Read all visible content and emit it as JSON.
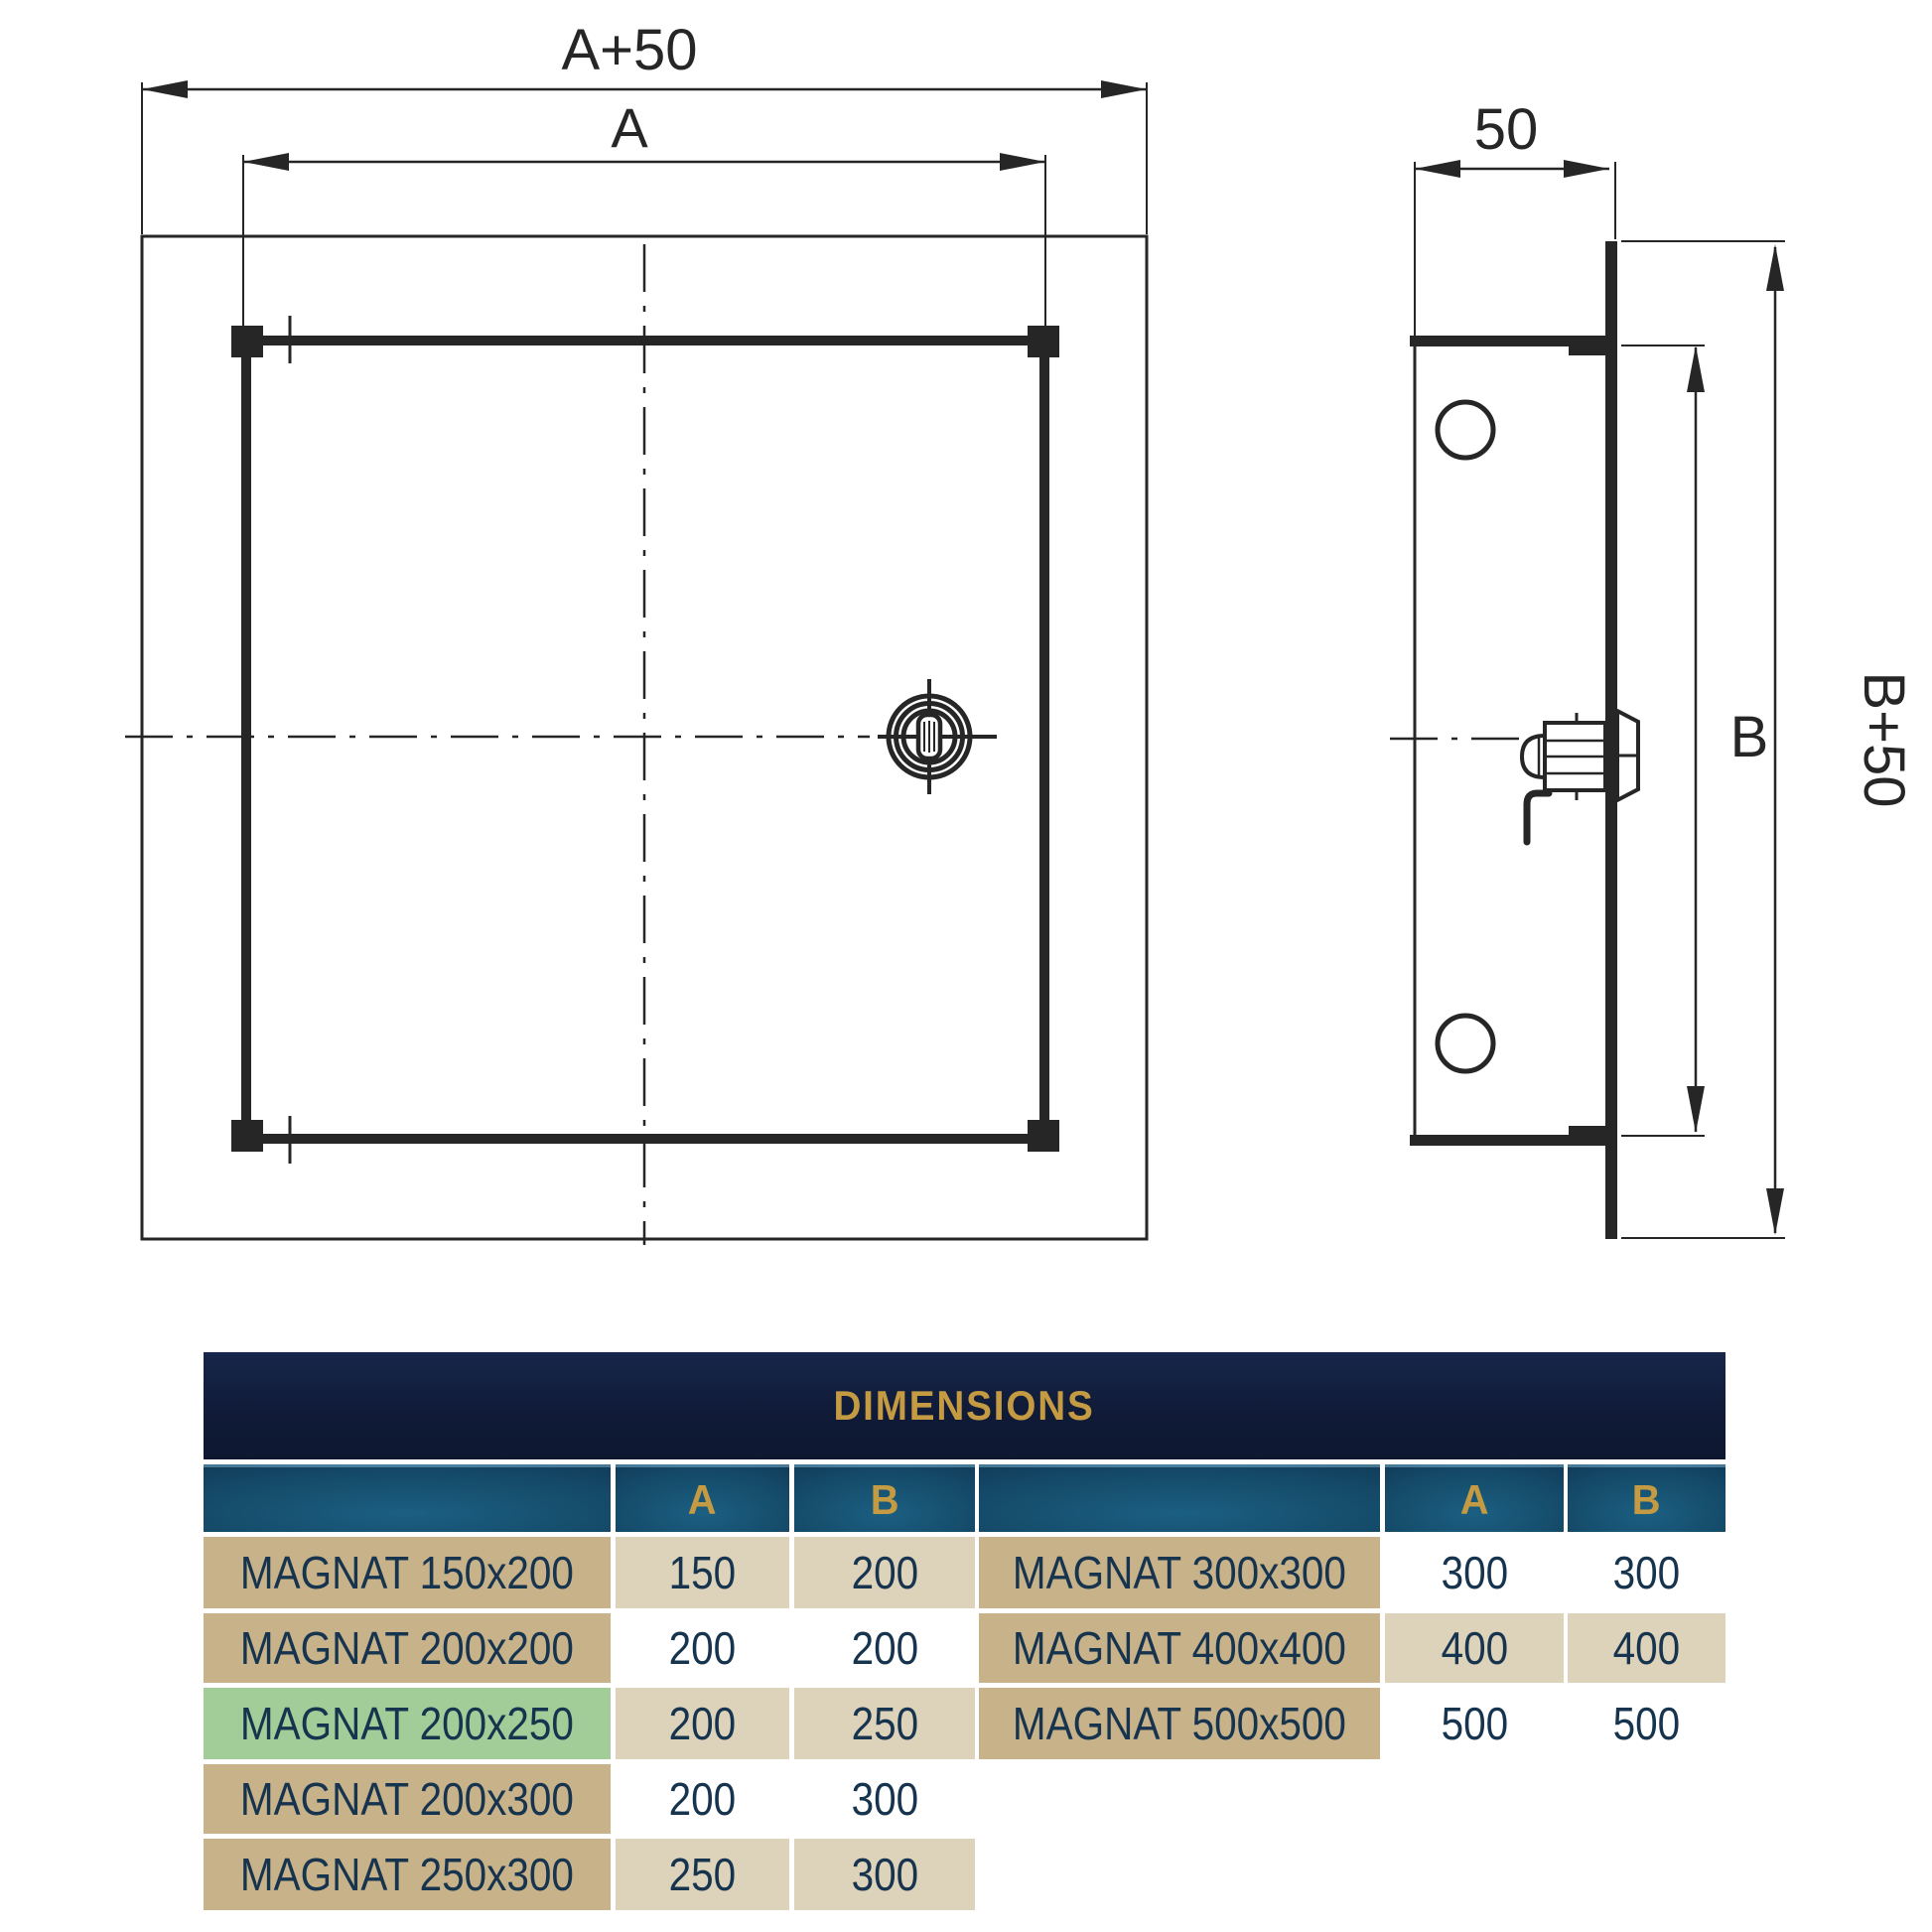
{
  "drawing": {
    "front_view": {
      "dim_outer_label": "A+50",
      "dim_inner_label": "A"
    },
    "side_view": {
      "dim_depth_label": "50",
      "dim_inner_label": "B",
      "dim_outer_label": "B+50"
    }
  },
  "table": {
    "title": "DIMENSIONS",
    "col_a_label": "A",
    "col_b_label": "B",
    "left_rows": [
      {
        "name": "MAGNAT 150x200",
        "a": "150",
        "b": "200",
        "name_bg": "tan",
        "val_bg": "lighttan"
      },
      {
        "name": "MAGNAT 200x200",
        "a": "200",
        "b": "200",
        "name_bg": "tan",
        "val_bg": "white"
      },
      {
        "name": "MAGNAT 200x250",
        "a": "200",
        "b": "250",
        "name_bg": "green",
        "val_bg": "lighttan"
      },
      {
        "name": "MAGNAT 200x300",
        "a": "200",
        "b": "300",
        "name_bg": "tan",
        "val_bg": "white"
      },
      {
        "name": "MAGNAT 250x300",
        "a": "250",
        "b": "300",
        "name_bg": "tan",
        "val_bg": "lighttan"
      }
    ],
    "right_rows": [
      {
        "name": "MAGNAT 300x300",
        "a": "300",
        "b": "300",
        "name_bg": "tan",
        "val_bg": "white"
      },
      {
        "name": "MAGNAT 400x400",
        "a": "400",
        "b": "400",
        "name_bg": "tan",
        "val_bg": "lighttan"
      },
      {
        "name": "MAGNAT 500x500",
        "a": "500",
        "b": "500",
        "name_bg": "tan",
        "val_bg": "white"
      }
    ],
    "colors": {
      "header_navy": "#101c38",
      "header_gold": "#c49a42",
      "header_cell_blue": "#144866",
      "cell_tan": "#c7b28a",
      "cell_light_tan": "#ddd2ba",
      "cell_green": "#a3cd98",
      "text_navy": "#17344f",
      "line_dark": "#262626"
    }
  }
}
